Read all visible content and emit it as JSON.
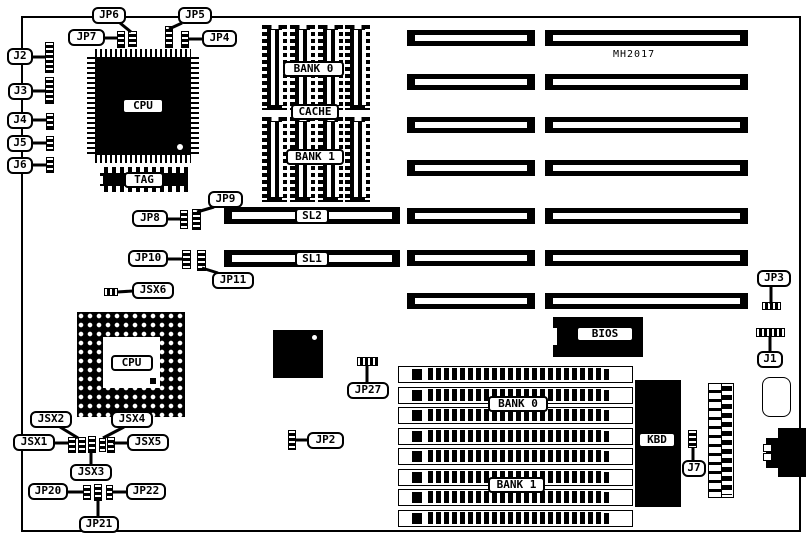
{
  "title": "MH2017 motherboard jumper location diagram",
  "board": {
    "x": 21,
    "y": 16,
    "w": 780,
    "h": 516,
    "model_text": "MH2017",
    "model_x": 613,
    "model_y": 49
  },
  "callouts": [
    {
      "label": "JP6",
      "x": 92,
      "y": 7,
      "w": 34,
      "tail": [
        120,
        23,
        131,
        32
      ]
    },
    {
      "label": "JP5",
      "x": 178,
      "y": 7,
      "w": 34,
      "tail": [
        182,
        23,
        169,
        29
      ]
    },
    {
      "label": "JP7",
      "x": 68,
      "y": 29,
      "w": 37,
      "tail": [
        104,
        38,
        118,
        38
      ]
    },
    {
      "label": "JP4",
      "x": 202,
      "y": 30,
      "w": 35,
      "tail": [
        203,
        39,
        188,
        39
      ]
    },
    {
      "label": "J2",
      "x": 7,
      "y": 48,
      "w": 26,
      "tail": [
        32,
        57,
        46,
        57
      ]
    },
    {
      "label": "J3",
      "x": 8,
      "y": 83,
      "w": 25,
      "tail": [
        32,
        91,
        46,
        91
      ]
    },
    {
      "label": "J4",
      "x": 7,
      "y": 112,
      "w": 26,
      "tail": [
        32,
        120,
        47,
        120
      ]
    },
    {
      "label": "J5",
      "x": 7,
      "y": 135,
      "w": 26,
      "tail": [
        32,
        143,
        47,
        143
      ]
    },
    {
      "label": "J6",
      "x": 7,
      "y": 157,
      "w": 26,
      "tail": [
        32,
        165,
        47,
        165
      ]
    },
    {
      "label": "JP9",
      "x": 208,
      "y": 191,
      "w": 35,
      "tail": [
        214,
        207,
        197,
        212
      ]
    },
    {
      "label": "JP8",
      "x": 132,
      "y": 210,
      "w": 36,
      "tail": [
        167,
        219,
        181,
        219
      ]
    },
    {
      "label": "JP10",
      "x": 128,
      "y": 250,
      "w": 40,
      "tail": [
        167,
        259,
        183,
        259
      ]
    },
    {
      "label": "JP11",
      "x": 212,
      "y": 272,
      "w": 42,
      "tail": [
        218,
        273,
        202,
        268
      ]
    },
    {
      "label": "JSX6",
      "x": 132,
      "y": 282,
      "w": 42,
      "tail": [
        133,
        291,
        117,
        292
      ]
    },
    {
      "label": "JP3",
      "x": 757,
      "y": 270,
      "w": 34,
      "tail": [
        771,
        286,
        771,
        304
      ]
    },
    {
      "label": "J1",
      "x": 757,
      "y": 351,
      "w": 26,
      "tail": [
        770,
        352,
        770,
        336
      ]
    },
    {
      "label": "JSX2",
      "x": 30,
      "y": 411,
      "w": 42,
      "tail": [
        60,
        427,
        78,
        438
      ]
    },
    {
      "label": "JSX4",
      "x": 111,
      "y": 411,
      "w": 42,
      "tail": [
        124,
        427,
        103,
        438
      ]
    },
    {
      "label": "JSX1",
      "x": 13,
      "y": 434,
      "w": 42,
      "tail": [
        54,
        443,
        69,
        443
      ]
    },
    {
      "label": "JSX5",
      "x": 127,
      "y": 434,
      "w": 42,
      "tail": [
        128,
        443,
        113,
        443
      ]
    },
    {
      "label": "JSX3",
      "x": 70,
      "y": 464,
      "w": 42,
      "tail": [
        91,
        465,
        91,
        451
      ]
    },
    {
      "label": "JP20",
      "x": 28,
      "y": 483,
      "w": 40,
      "tail": [
        67,
        492,
        84,
        492
      ]
    },
    {
      "label": "JP22",
      "x": 126,
      "y": 483,
      "w": 40,
      "tail": [
        127,
        492,
        112,
        492
      ]
    },
    {
      "label": "JP21",
      "x": 79,
      "y": 516,
      "w": 40,
      "tail": [
        98,
        517,
        98,
        500
      ]
    },
    {
      "label": "JP27",
      "x": 347,
      "y": 382,
      "w": 42,
      "tail": [
        367,
        383,
        367,
        365
      ]
    },
    {
      "label": "JP2",
      "x": 307,
      "y": 432,
      "w": 37,
      "tail": [
        308,
        440,
        295,
        440
      ]
    },
    {
      "label": "J7",
      "x": 682,
      "y": 460,
      "w": 24,
      "tail": [
        693,
        461,
        693,
        448
      ]
    }
  ],
  "jumpers": [
    {
      "id": "JP7 pins",
      "x": 117,
      "y": 31,
      "w": 8,
      "h": 17,
      "o": "v"
    },
    {
      "id": "JP6 pins",
      "x": 128,
      "y": 31,
      "w": 9,
      "h": 16,
      "o": "v"
    },
    {
      "id": "JP5 pins",
      "x": 165,
      "y": 26,
      "w": 8,
      "h": 22,
      "o": "v"
    },
    {
      "id": "JP4 pins",
      "x": 181,
      "y": 31,
      "w": 8,
      "h": 17,
      "o": "v"
    },
    {
      "id": "J2 pins",
      "x": 45,
      "y": 42,
      "w": 9,
      "h": 31,
      "o": "v"
    },
    {
      "id": "J3 pins",
      "x": 45,
      "y": 77,
      "w": 9,
      "h": 27,
      "o": "v"
    },
    {
      "id": "J4 pins",
      "x": 46,
      "y": 113,
      "w": 8,
      "h": 17,
      "o": "v"
    },
    {
      "id": "J5 pins",
      "x": 46,
      "y": 136,
      "w": 8,
      "h": 15,
      "o": "v"
    },
    {
      "id": "J6 pins",
      "x": 46,
      "y": 157,
      "w": 8,
      "h": 16,
      "o": "v"
    },
    {
      "id": "JP8 pins",
      "x": 180,
      "y": 210,
      "w": 8,
      "h": 19,
      "o": "v"
    },
    {
      "id": "JP9 pins",
      "x": 192,
      "y": 209,
      "w": 9,
      "h": 21,
      "o": "v"
    },
    {
      "id": "JP10 pins",
      "x": 182,
      "y": 250,
      "w": 9,
      "h": 19,
      "o": "v"
    },
    {
      "id": "JP11 pins",
      "x": 197,
      "y": 250,
      "w": 9,
      "h": 21,
      "o": "v"
    },
    {
      "id": "JSX6 pins",
      "x": 104,
      "y": 288,
      "w": 14,
      "h": 8,
      "o": "h"
    },
    {
      "id": "JP3 pins",
      "x": 762,
      "y": 302,
      "w": 19,
      "h": 8,
      "o": "h"
    },
    {
      "id": "J1 pins",
      "x": 756,
      "y": 328,
      "w": 29,
      "h": 9,
      "o": "h"
    },
    {
      "id": "JP27 pins",
      "x": 357,
      "y": 357,
      "w": 21,
      "h": 9,
      "o": "h"
    },
    {
      "id": "JP2 pins",
      "x": 288,
      "y": 430,
      "w": 8,
      "h": 20,
      "o": "v"
    },
    {
      "id": "J7 pins",
      "x": 688,
      "y": 430,
      "w": 9,
      "h": 18,
      "o": "v"
    },
    {
      "id": "JSX cluster a",
      "x": 68,
      "y": 437,
      "w": 8,
      "h": 16,
      "o": "v"
    },
    {
      "id": "JSX cluster b",
      "x": 78,
      "y": 437,
      "w": 8,
      "h": 16,
      "o": "v"
    },
    {
      "id": "JSX cluster c",
      "x": 88,
      "y": 436,
      "w": 8,
      "h": 17,
      "o": "v"
    },
    {
      "id": "JSX cluster d",
      "x": 99,
      "y": 438,
      "w": 7,
      "h": 14,
      "o": "v"
    },
    {
      "id": "JSX cluster e",
      "x": 107,
      "y": 437,
      "w": 8,
      "h": 16,
      "o": "v"
    },
    {
      "id": "JP20 pins",
      "x": 83,
      "y": 485,
      "w": 8,
      "h": 15,
      "o": "v"
    },
    {
      "id": "JP21 pins",
      "x": 94,
      "y": 484,
      "w": 8,
      "h": 17,
      "o": "v"
    },
    {
      "id": "JP22 pins",
      "x": 106,
      "y": 485,
      "w": 7,
      "h": 15,
      "o": "v"
    }
  ],
  "isa": {
    "rows_y": [
      30,
      74,
      117,
      160,
      208,
      250,
      293
    ],
    "h": 16,
    "cols": [
      {
        "x": 407,
        "w": 128
      },
      {
        "x": 545,
        "w": 203
      }
    ]
  },
  "sl_slots": [
    {
      "label": "SL2",
      "x": 224,
      "y": 207,
      "w": 176,
      "h": 17
    },
    {
      "label": "SL1",
      "x": 224,
      "y": 250,
      "w": 176,
      "h": 17
    }
  ],
  "cache": {
    "bank_y": [
      25,
      117
    ],
    "chip_xs": [
      262,
      290,
      318,
      345
    ],
    "chip_w": 25,
    "chip_h": 85,
    "labels": [
      {
        "text": "BANK 0",
        "x": 283,
        "y": 61,
        "w": 61
      },
      {
        "text": "CACHE",
        "x": 291,
        "y": 104,
        "w": 48
      },
      {
        "text": "BANK 1",
        "x": 286,
        "y": 149,
        "w": 58
      }
    ]
  },
  "simm": {
    "x": 398,
    "w": 235,
    "h": 17,
    "rows_y": [
      366,
      387,
      407,
      428,
      448,
      469,
      489,
      510
    ],
    "labels": [
      {
        "text": "BANK 0",
        "x": 488,
        "y": 396,
        "w": 60
      },
      {
        "text": "BANK 1",
        "x": 488,
        "y": 477,
        "w": 57
      }
    ]
  },
  "chips": {
    "cpu1": {
      "label": "CPU",
      "x": 87,
      "y": 49,
      "w": 112,
      "h": 114
    },
    "cpu2": {
      "label": "CPU",
      "x": 77,
      "y": 312,
      "w": 108,
      "h": 105
    },
    "tag": {
      "label": "TAG",
      "x": 100,
      "y": 167,
      "w": 88,
      "h": 25
    },
    "bios": {
      "label": "BIOS",
      "x": 553,
      "y": 317,
      "w": 90,
      "h": 40
    },
    "kbd": {
      "label": "KBD",
      "x": 635,
      "y": 380,
      "w": 46,
      "h": 127
    },
    "chipset": {
      "x": 273,
      "y": 330,
      "w": 50,
      "h": 48
    }
  },
  "misc": {
    "pin_header": {
      "x": 708,
      "y": 383,
      "w": 26,
      "h": 115
    },
    "battery": {
      "x": 762,
      "y": 377,
      "w": 29,
      "h": 40
    },
    "din": {
      "x": 763,
      "y": 428,
      "w": 43,
      "h": 49
    }
  }
}
